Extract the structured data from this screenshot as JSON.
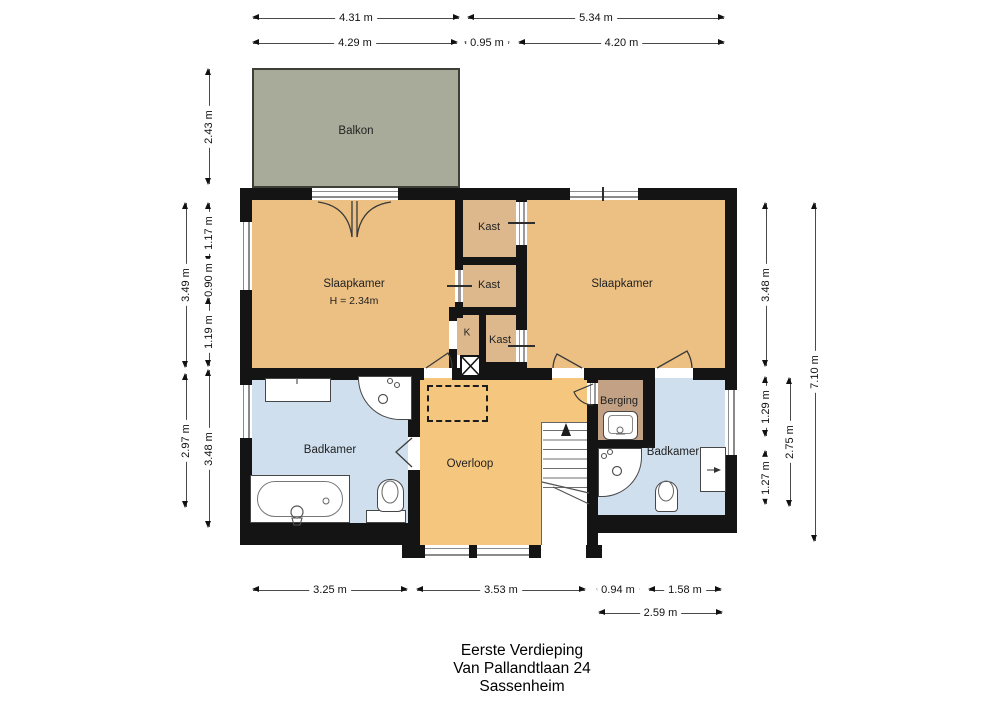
{
  "title": {
    "floor": "Eerste Verdieping",
    "address": "Van Pallandtlaan 24",
    "city": "Sassenheim"
  },
  "rooms": {
    "balkon": "Balkon",
    "slaapkamer_left": "Slaapkamer",
    "slaapkamer_left_height": "H = 2.34m",
    "kast_top": "Kast",
    "kast_mid": "Kast",
    "kast_bot": "Kast",
    "k_label": "K",
    "slaapkamer_right": "Slaapkamer",
    "badkamer_left": "Badkamer",
    "overloop": "Overloop",
    "berging": "Berging",
    "badkamer_right": "Badkamer"
  },
  "dims": {
    "top": [
      "4.31 m",
      "5.34 m",
      "4.29 m",
      "0.95 m",
      "4.20 m"
    ],
    "left": [
      "2.43 m",
      "3.49 m",
      "1.17 m",
      "0.90 m",
      "1.19 m",
      "2.97 m",
      "3.48 m"
    ],
    "right": [
      "3.48 m",
      "1.29 m",
      "1.27 m",
      "2.75 m",
      "7.10 m"
    ],
    "bottom": [
      "3.25 m",
      "3.53 m",
      "0.94 m",
      "1.58 m",
      "2.59 m"
    ]
  },
  "colors": {
    "wall": "#141414",
    "bedroom": "#ecc083",
    "closet": "#dcb88c",
    "hall": "#f5c67e",
    "bathroom": "#cfdfee",
    "storage": "#c2a184",
    "balcony": "#a8ab9a",
    "window_line": "#8b8b8b",
    "dim_line": "#4a4a4a",
    "text": "#1a1a1a"
  }
}
